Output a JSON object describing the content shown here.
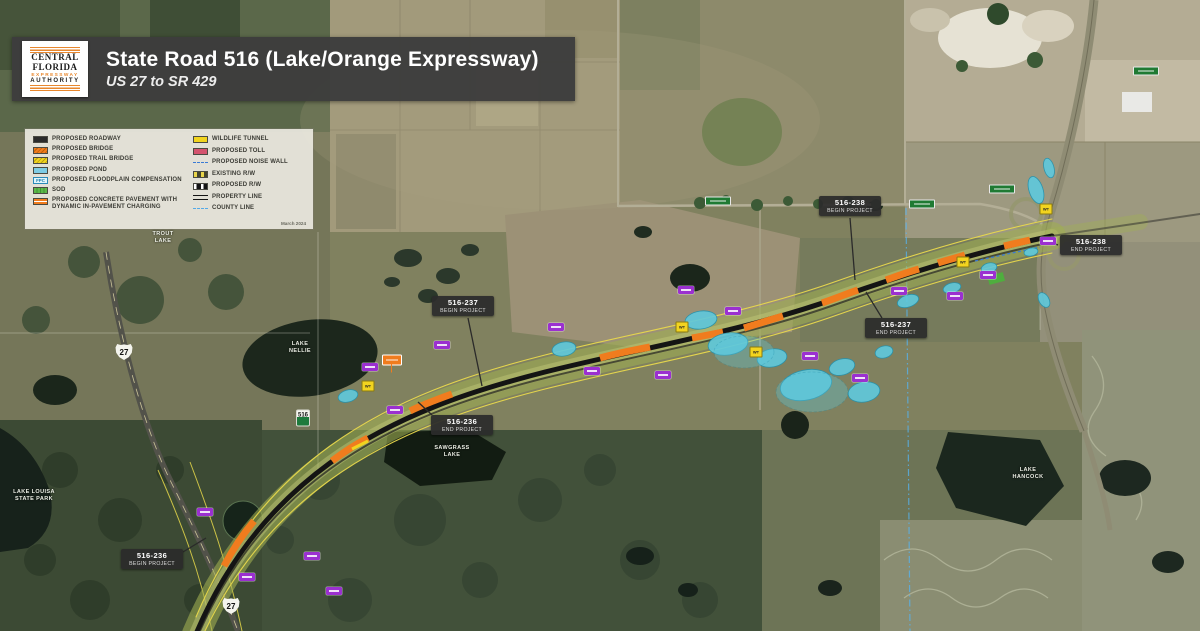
{
  "header": {
    "logo": {
      "line1": "CENTRAL",
      "line2": "FLORIDA",
      "line3": "EXPRESSWAY",
      "line4": "AUTHORITY"
    },
    "title": "State Road 516 (Lake/Orange Expressway)",
    "subtitle": "US 27 to SR 429"
  },
  "legend": {
    "date": "March 2024",
    "left": [
      {
        "label": "PROPOSED ROADWAY",
        "swatch": "roadway"
      },
      {
        "label": "PROPOSED BRIDGE",
        "swatch": "bridge"
      },
      {
        "label": "PROPOSED TRAIL BRIDGE",
        "swatch": "trail-bridge"
      },
      {
        "label": "PROPOSED POND",
        "swatch": "pond"
      },
      {
        "label": "PROPOSED FLOODPLAIN COMPENSATION",
        "swatch": "fpc",
        "swatch_text": "FPC"
      },
      {
        "label": "SOD",
        "swatch": "sod"
      },
      {
        "label": "PROPOSED CONCRETE PAVEMENT WITH DYNAMIC IN-PAVEMENT CHARGING",
        "swatch": "charging"
      }
    ],
    "right": [
      {
        "label": "WILDLIFE TUNNEL",
        "swatch": "wildlife"
      },
      {
        "label": "PROPOSED TOLL",
        "swatch": "toll"
      },
      {
        "label": "PROPOSED NOISE WALL",
        "swatch": "noise-wall"
      },
      {
        "label": "EXISTING R/W",
        "swatch": "existing-rw"
      },
      {
        "label": "PROPOSED R/W",
        "swatch": "proposed-rw"
      },
      {
        "label": "PROPERTY LINE",
        "swatch": "property-line"
      },
      {
        "label": "COUNTY LINE",
        "swatch": "county-line"
      }
    ]
  },
  "map": {
    "project_callouts": [
      {
        "id": "516-238",
        "phase": "BEGIN PROJECT",
        "x": 850,
        "y": 206
      },
      {
        "id": "516-238",
        "phase": "END PROJECT",
        "x": 1091,
        "y": 245
      },
      {
        "id": "516-237",
        "phase": "BEGIN PROJECT",
        "x": 463,
        "y": 306
      },
      {
        "id": "516-237",
        "phase": "END PROJECT",
        "x": 896,
        "y": 328
      },
      {
        "id": "516-236",
        "phase": "END PROJECT",
        "x": 462,
        "y": 425
      },
      {
        "id": "516-236",
        "phase": "BEGIN PROJECT",
        "x": 152,
        "y": 559
      }
    ],
    "route_shields": [
      {
        "kind": "us",
        "label": "27",
        "x": 124,
        "y": 352
      },
      {
        "kind": "us",
        "label": "27",
        "x": 231,
        "y": 606
      },
      {
        "kind": "sr",
        "label": "516",
        "x": 303,
        "y": 418
      }
    ],
    "lake_labels": [
      {
        "text": "TROUT LAKE",
        "x": 163,
        "y": 238,
        "w": 34
      },
      {
        "text": "LAKE NELLIE",
        "x": 300,
        "y": 348,
        "w": 34
      },
      {
        "text": "SAWGRASS LAKE",
        "x": 452,
        "y": 452,
        "w": 52
      },
      {
        "text": "LAKE LOUISA STATE PARK",
        "x": 34,
        "y": 496,
        "w": 52
      },
      {
        "text": "LAKE HANCOCK",
        "x": 1028,
        "y": 474,
        "w": 46
      }
    ],
    "wildlife_marker_text": "WT",
    "pond_markers": [
      [
        370,
        367
      ],
      [
        556,
        327
      ],
      [
        592,
        371
      ],
      [
        663,
        375
      ],
      [
        686,
        290
      ],
      [
        733,
        311
      ],
      [
        810,
        356
      ],
      [
        860,
        378
      ],
      [
        899,
        291
      ],
      [
        955,
        296
      ],
      [
        988,
        275
      ],
      [
        1048,
        241
      ],
      [
        205,
        512
      ],
      [
        247,
        577
      ],
      [
        312,
        556
      ],
      [
        334,
        591
      ],
      [
        395,
        410
      ],
      [
        442,
        345
      ]
    ],
    "wildlife_markers": [
      [
        368,
        386
      ],
      [
        682,
        327
      ],
      [
        756,
        352
      ],
      [
        963,
        262
      ],
      [
        1046,
        209
      ]
    ],
    "street_signs": [
      [
        718,
        201
      ],
      [
        922,
        204
      ],
      [
        1002,
        189
      ],
      [
        1146,
        71
      ]
    ],
    "bridge_callout": {
      "x": 392,
      "y": 360
    },
    "colors": {
      "bridge": "#f07c1e",
      "pond": "#5fc8dc",
      "sod": "#6cc24a",
      "toll": "#d4546e",
      "wildlife": "#f2d41f",
      "pond_label": "#9b30d0",
      "noise_wall": "#3a7bd5",
      "banner_bg": "#3d3d3d",
      "logo_accent": "#e8872e"
    }
  }
}
